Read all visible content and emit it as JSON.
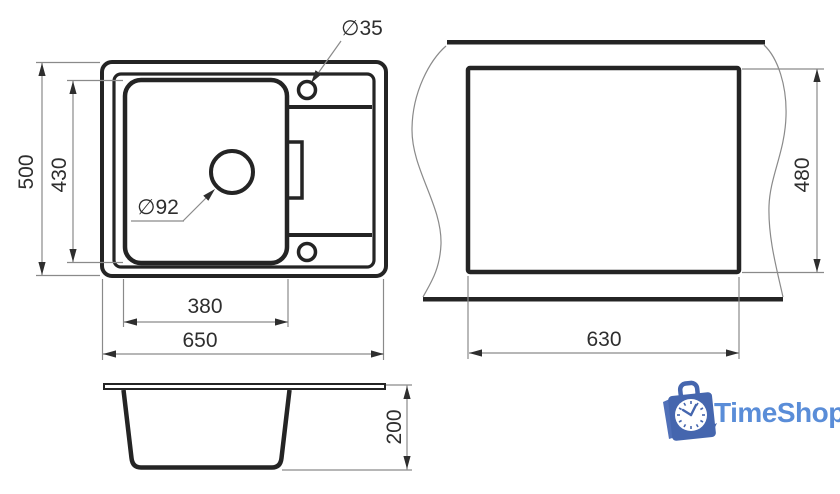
{
  "drawing": {
    "top_view": {
      "name": "sink top view",
      "overall_width": "650",
      "overall_depth": "500",
      "bowl_width": "380",
      "bowl_depth": "430",
      "drain_diameter": "∅92",
      "faucet_hole_diameter": "∅35"
    },
    "cutout_view": {
      "name": "countertop cutout view",
      "cutout_width": "630",
      "cutout_depth": "480"
    },
    "side_view": {
      "name": "sink side section view",
      "bowl_height": "200"
    },
    "line_color": "#242424",
    "dim_line_color": "#8a8a8a"
  },
  "logo": {
    "text": "TimeShop",
    "icon": "shopping-bag-clock-icon",
    "bag_blue": "#4566ae",
    "text_blue": "#5a8dd8"
  }
}
